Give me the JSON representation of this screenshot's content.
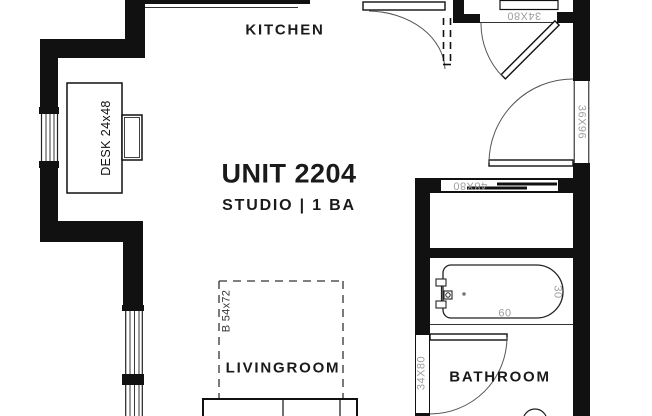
{
  "plan": {
    "unit_title": "UNIT 2204",
    "unit_subtitle": "STUDIO | 1 BA",
    "rooms": {
      "kitchen": "KITCHEN",
      "livingroom": "LIVINGROOM",
      "bathroom": "BATHROOM"
    },
    "furniture": {
      "desk": "DESK 24x48",
      "bed": "B 54x72"
    },
    "openings": {
      "entry_door": "34X80",
      "closet_door": "48X80",
      "right_opening": "36X96",
      "bathroom_door": "34X80"
    },
    "fixtures": {
      "tub_length": "60",
      "tub_width": "30"
    },
    "colors": {
      "wall": "#111111",
      "annotation": "#9e9e9e",
      "line": "#333333",
      "background": "#ffffff"
    }
  }
}
